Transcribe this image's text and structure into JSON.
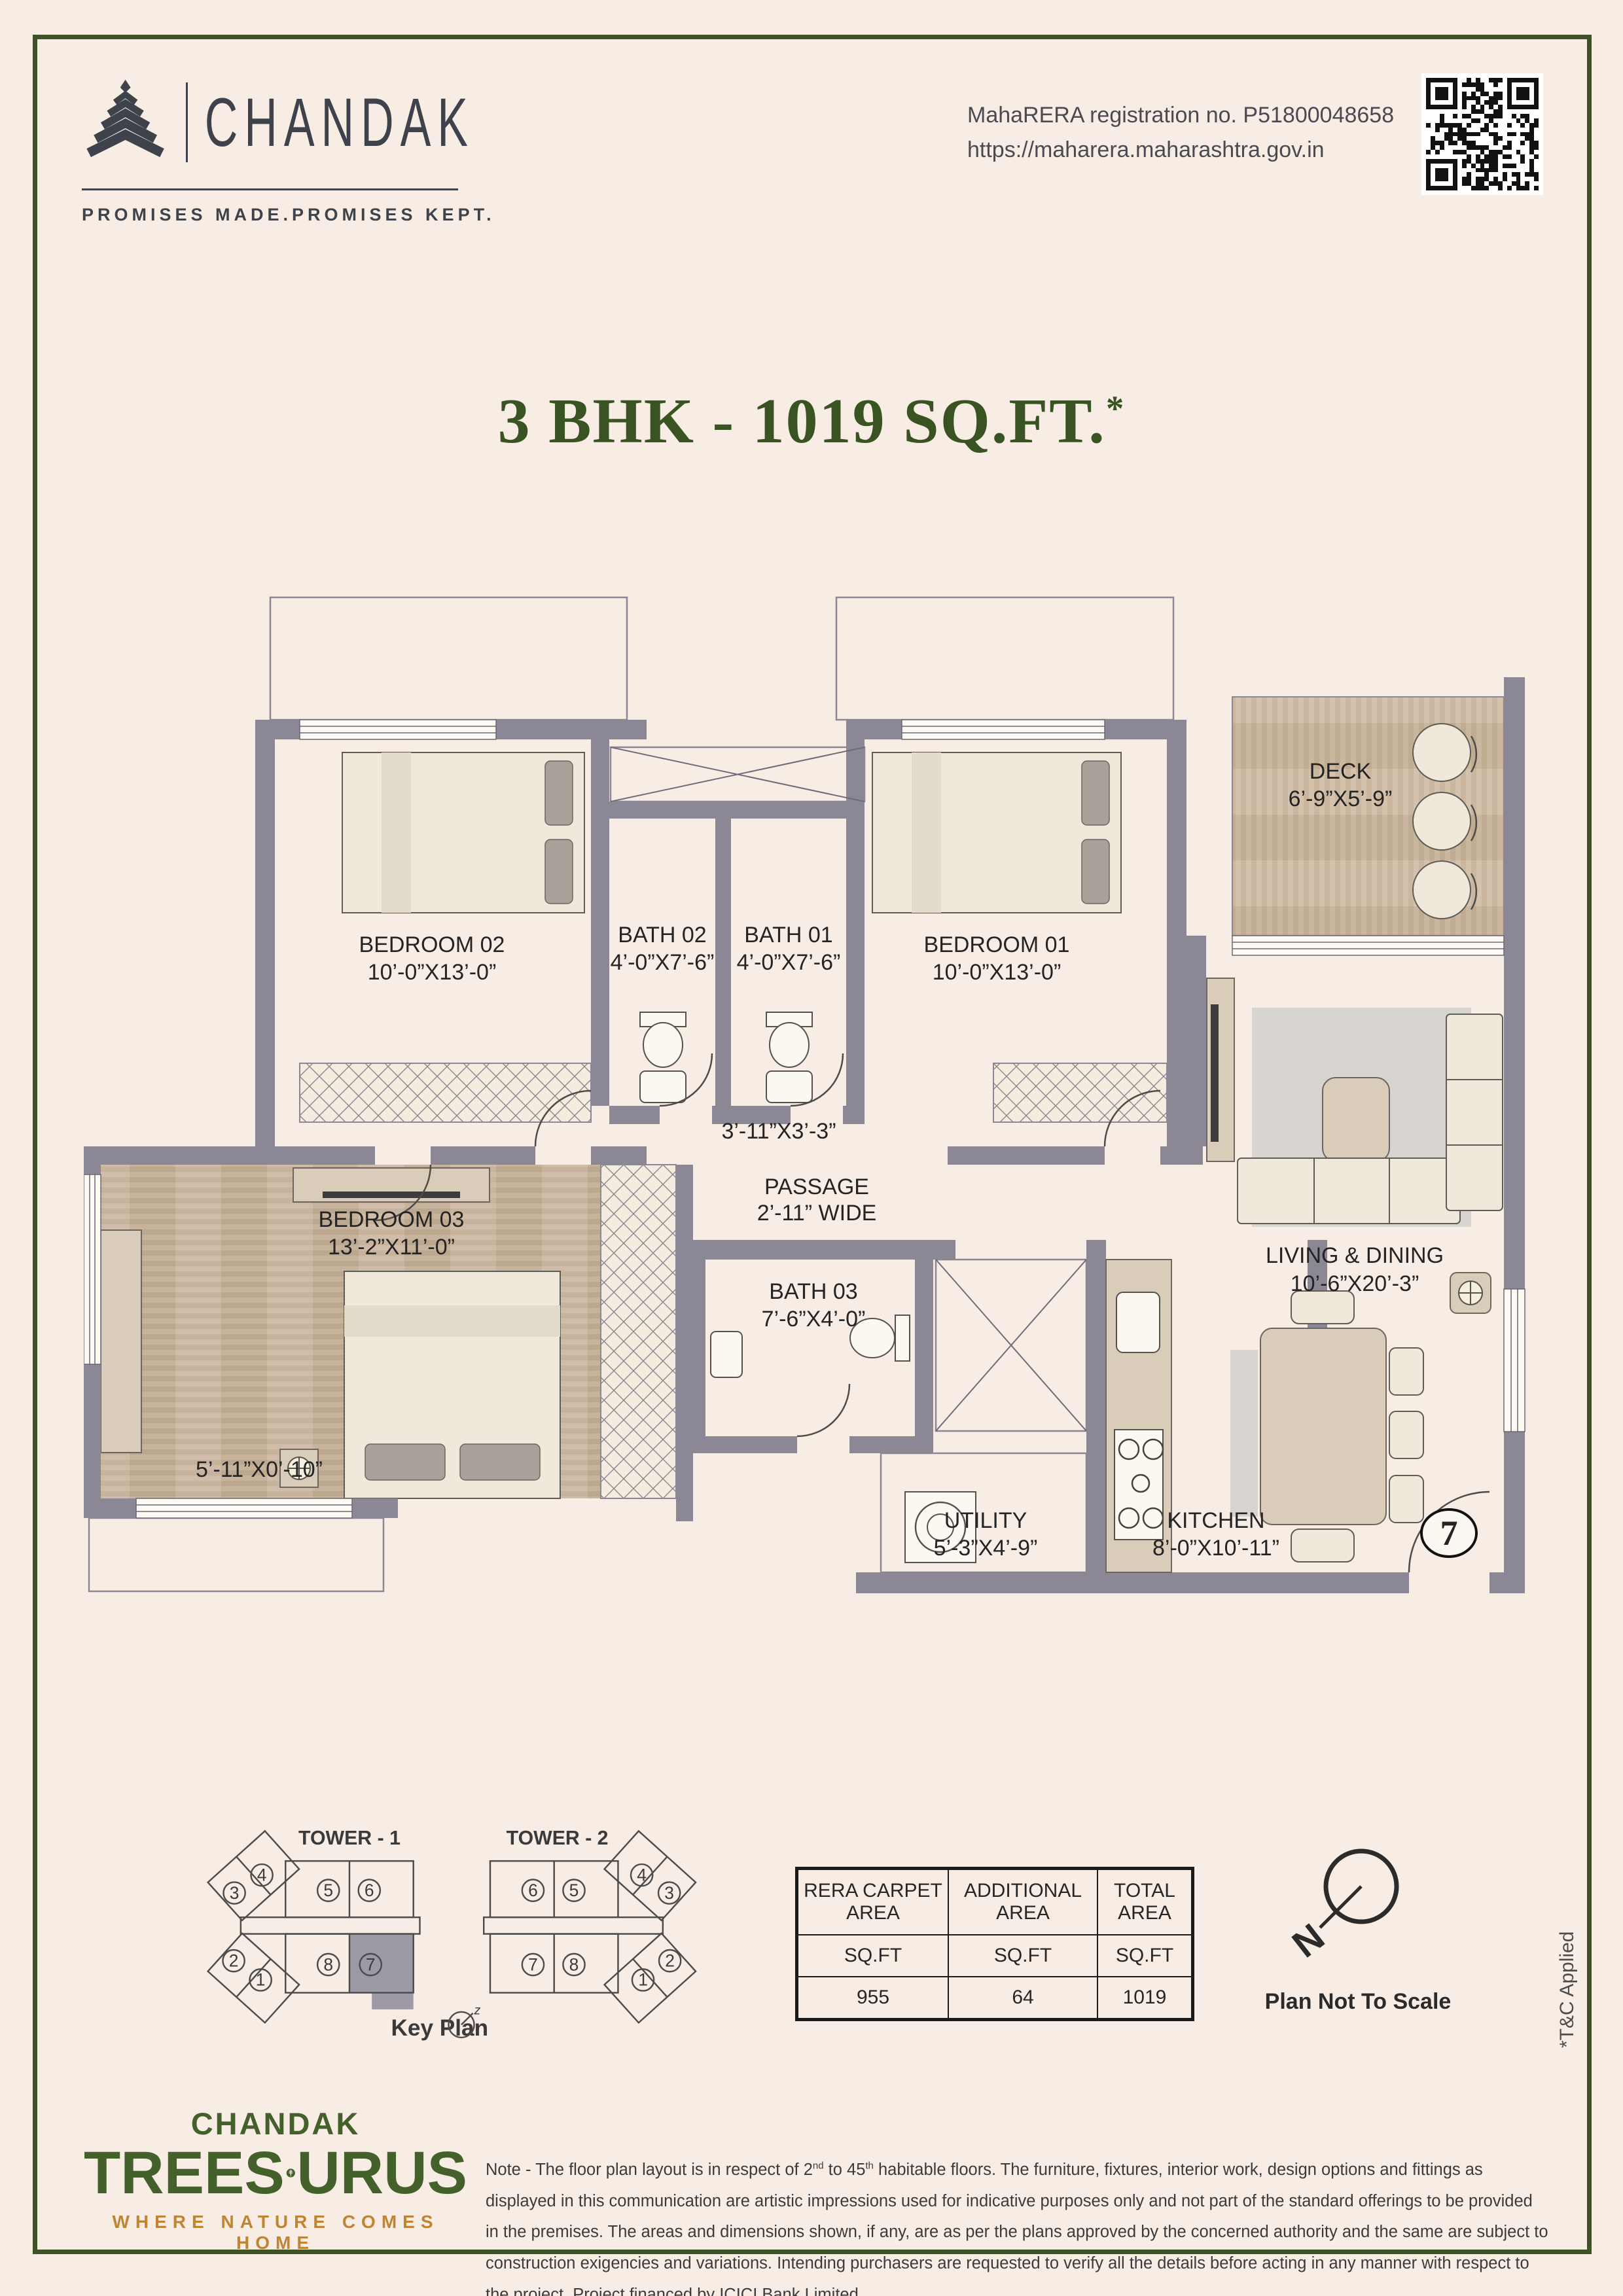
{
  "header": {
    "brand": "CHANDAK",
    "tagline": "PROMISES MADE.PROMISES KEPT.",
    "rera_line1": "MahaRERA registration no. P51800048658",
    "rera_line2": "https://maharera.maharashtra.gov.in"
  },
  "title": {
    "main": "3 BHK - 1019 SQ.FT.",
    "sup": "*"
  },
  "floor_plan": {
    "rooms": [
      {
        "id": "bedroom02",
        "name": "BEDROOM 02",
        "dims": "10’-0”X13’-0”"
      },
      {
        "id": "bath02",
        "name": "BATH 02",
        "dims": "4’-0”X7’-6”"
      },
      {
        "id": "bath01",
        "name": "BATH 01",
        "dims": "4’-0”X7’-6”"
      },
      {
        "id": "bedroom01",
        "name": "BEDROOM 01",
        "dims": "10’-0”X13’-0”"
      },
      {
        "id": "deck",
        "name": "DECK",
        "dims": "6’-9”X5’-9”"
      },
      {
        "id": "bedroom03",
        "name": "BEDROOM 03",
        "dims": "13’-2”X11’-0”"
      },
      {
        "id": "bath03",
        "name": "BATH 03",
        "dims": "7’-6”X4’-0”"
      },
      {
        "id": "passage",
        "name": "PASSAGE",
        "dims": "2’-11” WIDE"
      },
      {
        "id": "utility",
        "name": "UTILITY",
        "dims": "5’-3”X4’-9”"
      },
      {
        "id": "kitchen",
        "name": "KITCHEN",
        "dims": "8’-0”X10’-11”"
      },
      {
        "id": "living",
        "name": "LIVING & DINING",
        "dims": "10’-6”X20’-3”"
      }
    ],
    "foyer_dims": "3’-11”X3’-3”",
    "ledge_dims": "5’-11”X0’-10”",
    "unit_number": "7"
  },
  "key_plan": {
    "tower1_label": "TOWER - 1",
    "tower2_label": "TOWER - 2",
    "caption": "Key Plan",
    "t1_units": [
      "3",
      "4",
      "5",
      "6",
      "8",
      "7",
      "2",
      "1"
    ],
    "t2_units": [
      "6",
      "5",
      "4",
      "3",
      "7",
      "8",
      "1",
      "2"
    ]
  },
  "area_table": {
    "headers": [
      "RERA CARPET\nAREA",
      "ADDITIONAL\nAREA",
      "TOTAL\nAREA"
    ],
    "unit_row": [
      "SQ.FT",
      "SQ.FT",
      "SQ.FT"
    ],
    "values": [
      "955",
      "64",
      "1019"
    ]
  },
  "annotations": {
    "scale_note": "Plan Not To Scale",
    "tc_note": "*T&C Applied",
    "north_letter": "N"
  },
  "footer": {
    "brand_top": "CHANDAK",
    "brand_left": "TREES",
    "brand_right": "URUS",
    "brand_sub": "WHERE NATURE COMES HOME",
    "note_p1": "Note - The floor plan layout is in respect of 2",
    "note_sup1": "nd",
    "note_p2": " to 45",
    "note_sup2": "th",
    "note_p3": " habitable floors. The furniture, fixtures, interior work, design options and fittings as displayed in this communication are artistic impressions used for indicative purposes only and not part of the standard offerings to be provided in the premises. The areas and dimensions shown, if any, are as per the plans approved by the concerned authority and the same are subject to construction exigencies and variations. Intending purchasers are requested to verify all the details before acting in any manner with respect to the project. Project financed by ICICI Bank Limited."
  }
}
